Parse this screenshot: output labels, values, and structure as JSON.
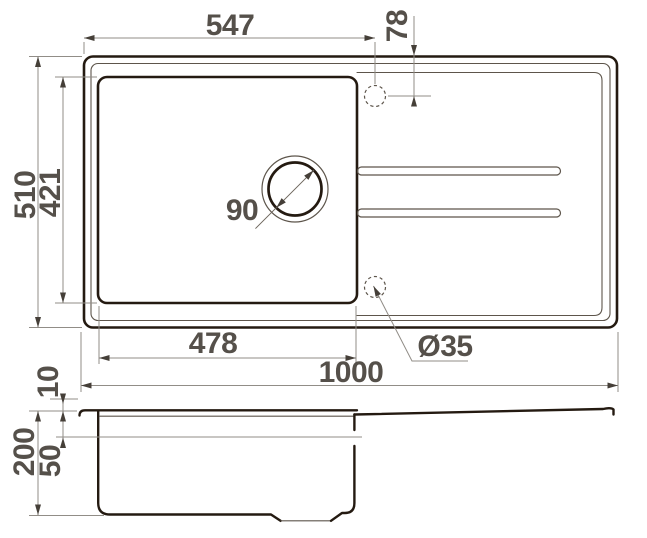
{
  "drawing": {
    "title": "Kitchen sink technical dimension drawing, top view and section view",
    "colors": {
      "dark": "#241a11",
      "medium": "#5d554b",
      "light": "#918d87",
      "arrow": "#453f38",
      "text": "#55504a",
      "background": "#ffffff"
    },
    "top_view": {
      "dim_top_width": "547",
      "dim_hole_offset": "78",
      "dim_overall_depth": "510",
      "dim_bowl_depth": "421",
      "dim_drain_diameter": "90",
      "dim_bowl_width": "478",
      "dim_hole_diameter": "Ø35",
      "dim_overall_length": "1000"
    },
    "side_view": {
      "dim_rim_height": "10",
      "dim_total_depth": "200",
      "dim_ledge_depth": "50"
    }
  }
}
